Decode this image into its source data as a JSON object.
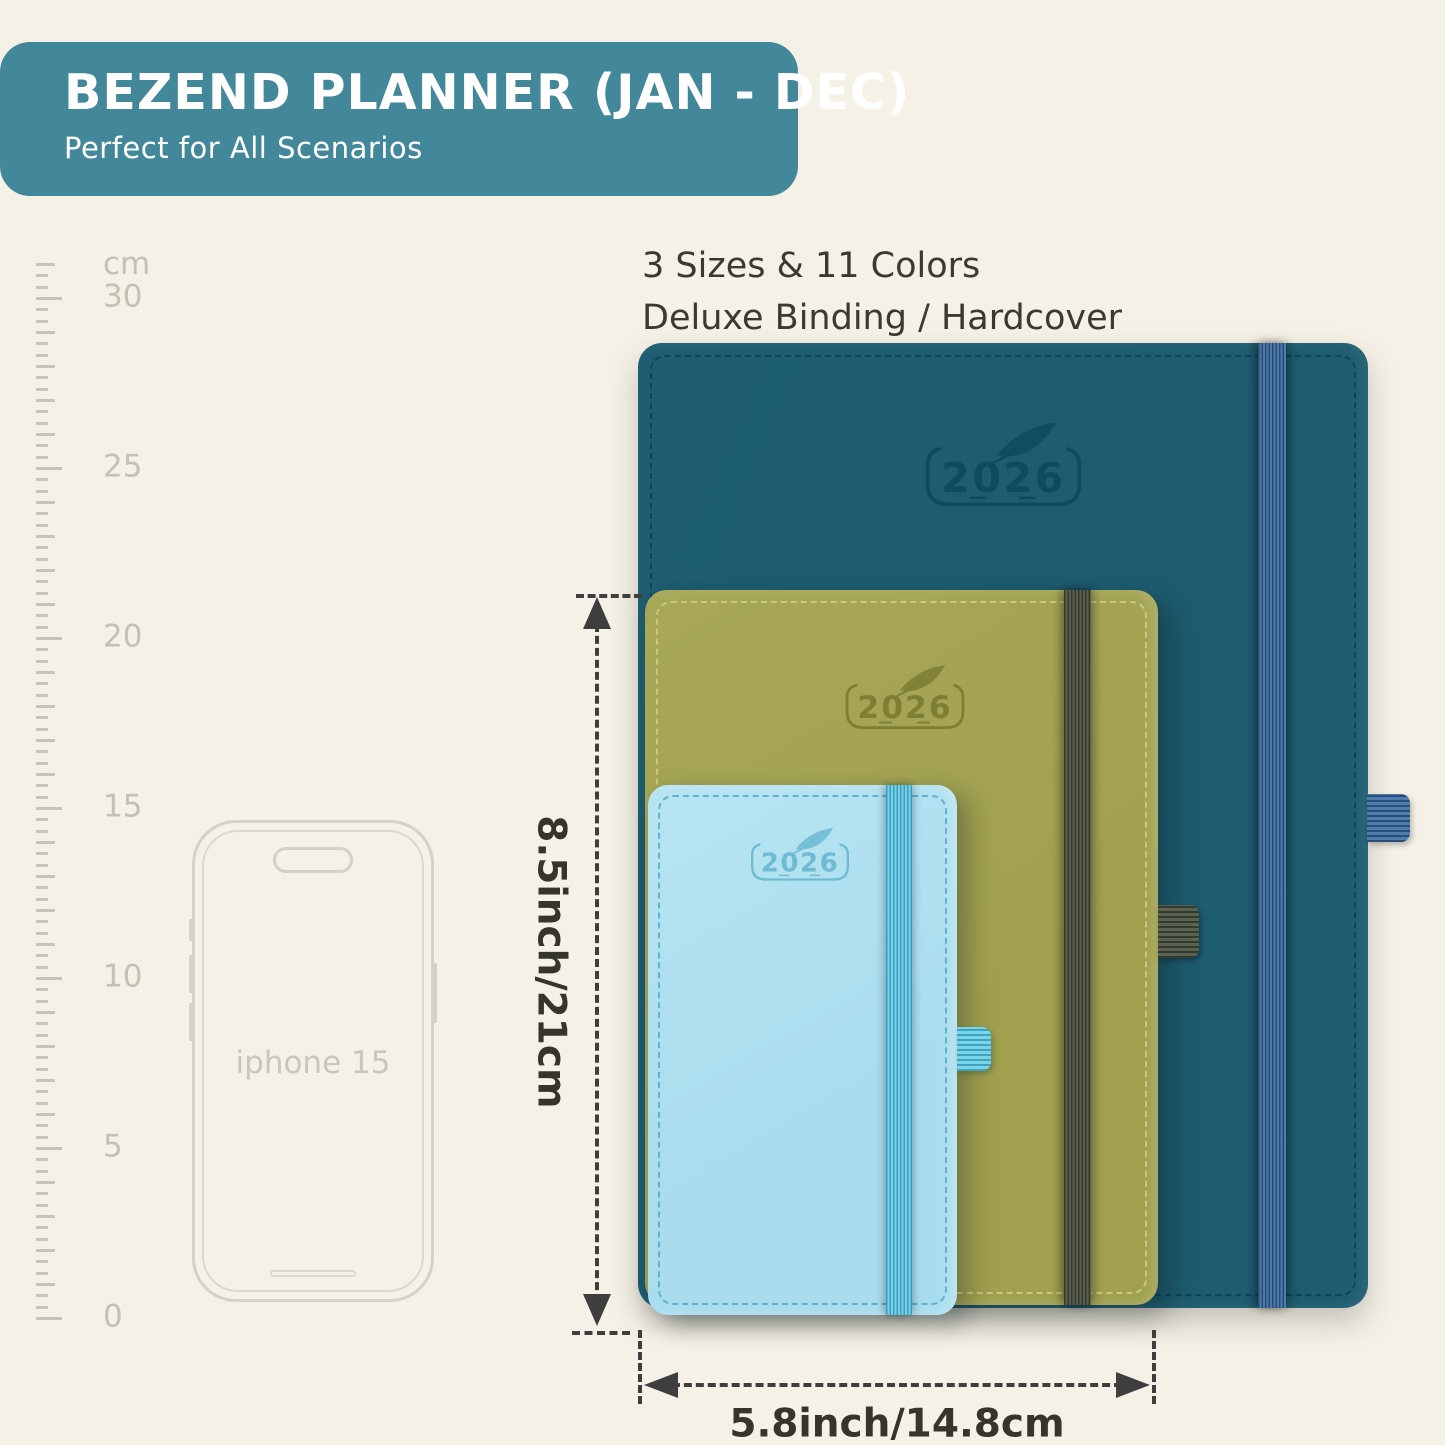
{
  "header": {
    "title": "BEZEND PLANNER (JAN - DEC)",
    "subtitle": "Perfect for All Scenarios"
  },
  "features": {
    "line1": "3 Sizes & 11 Colors",
    "line2": "Deluxe Binding / Hardcover"
  },
  "ruler": {
    "unit": "cm",
    "major_labels": [
      "30",
      "25",
      "20",
      "15",
      "10",
      "5",
      "0"
    ]
  },
  "phone": {
    "label": "iphone 15"
  },
  "planners": {
    "large": {
      "year": "2026",
      "cover_color": "#1E5C70",
      "band_color": "#3A6CA3"
    },
    "medium": {
      "year": "2026",
      "cover_color": "#A0A04F",
      "band_color": "#4C5340"
    },
    "small": {
      "year": "2026",
      "cover_color": "#A9DDEE",
      "band_color": "#54C8E9"
    }
  },
  "dimensions": {
    "height_label": "8.5inch/21cm",
    "width_label": "5.8inch/14.8cm"
  },
  "colors": {
    "background": "#F6F1E7",
    "header_bg": "#42889A",
    "text_dark": "#3A3A32",
    "dimension_line": "#3E3E3E",
    "ruler_marks": "#C8C3B7"
  }
}
